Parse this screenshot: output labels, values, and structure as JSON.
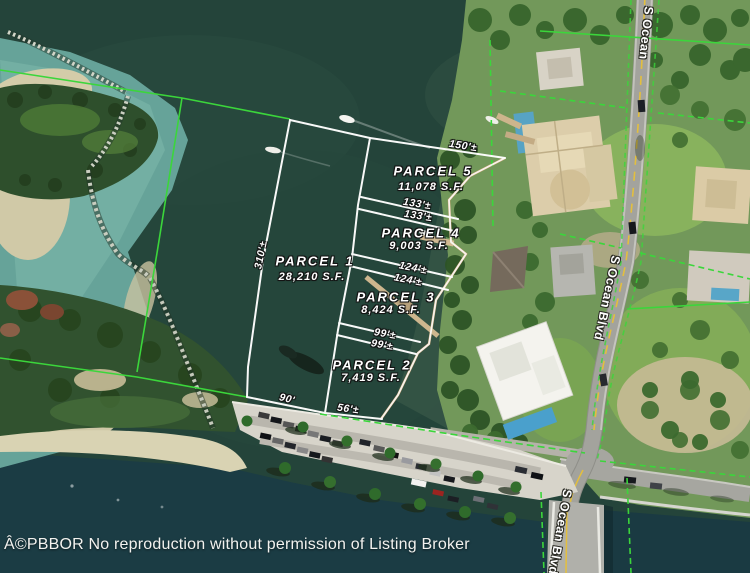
{
  "map": {
    "copyright": "Â©PBBOR No reproduction without permission of Listing Broker"
  },
  "parcels": [
    {
      "name": "PARCEL 1",
      "area": "28,210 S.F."
    },
    {
      "name": "PARCEL 2",
      "area": "7,419 S.F."
    },
    {
      "name": "PARCEL 3",
      "area": "8,424 S.F."
    },
    {
      "name": "PARCEL 4",
      "area": "9,003 S.F."
    },
    {
      "name": "PARCEL 5",
      "area": "11,078 S.F."
    }
  ],
  "dimensions": [
    {
      "label": "150'±"
    },
    {
      "label": "133'±"
    },
    {
      "label": "133'±"
    },
    {
      "label": "124'±"
    },
    {
      "label": "124'±"
    },
    {
      "label": "99'±"
    },
    {
      "label": "99'±"
    },
    {
      "label": "310'±"
    },
    {
      "label": "90'"
    },
    {
      "label": "56'±"
    }
  ],
  "road_labels": [
    {
      "text": "S Ocean"
    },
    {
      "text": "S Ocean Blvd"
    },
    {
      "text": "S Ocean Blvd"
    }
  ],
  "colors": {
    "parcel_line": "#ffffff",
    "gis_line": "#3bd63b",
    "water": "#24443a",
    "road_centerline": "#e3bf3e"
  }
}
